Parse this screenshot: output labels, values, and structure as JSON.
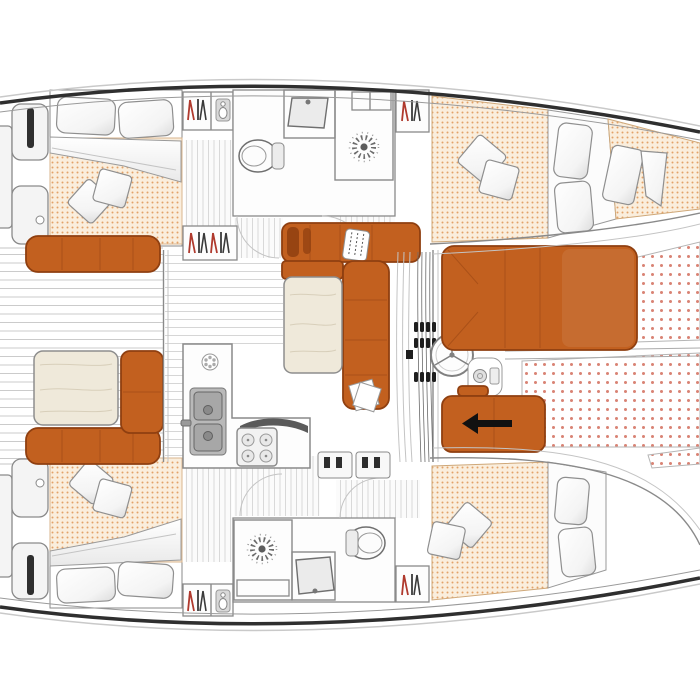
{
  "meta": {
    "title": "Catamaran interior deck layout plan, top-down view, bow to the right",
    "view": "top-down floor plan",
    "orientation_bow": "right"
  },
  "palette": {
    "hull_outline": "#2f2f2f",
    "hull_inner_line": "#9a9a9a",
    "wall": "#8a8a8a",
    "light_line": "#c4c4c4",
    "floor_line": "#d6d6d6",
    "teak_line": "#cbcbcb",
    "upholstery": "#c2601f",
    "upholstery_dark": "#8f3f10",
    "mattress_bg": "#faeedd",
    "mattress_dot": "#e3a268",
    "trampoline_dot": "#d98374",
    "wood_table": "#efe9da",
    "wood_grain": "#d8cfba",
    "fixture_fill": "#f4f4f4",
    "steel": "#b9b9b9",
    "hanger_red": "#b03a2e",
    "hanger_dark": "#3a3a3a",
    "arrow": "#111111",
    "step_tread": "#2e2e2e"
  },
  "regions": {
    "stern_platforms": {
      "label": "Stern swim platforms and transom steps"
    },
    "aft_cockpit": {
      "label": "Aft cockpit with teak floor, bench seats and table"
    },
    "saloon": {
      "label": "Saloon with L-shaped sofa and dining table"
    },
    "galley": {
      "label": "Galley with double sink, hob control and 4-burner stove"
    },
    "helm": {
      "label": "Helm station with steering wheel, winch and line clutches"
    },
    "fwd_cockpit": {
      "label": "Forward cockpit with sunpad lounge and sliding bench"
    },
    "trampoline": {
      "label": "Bow trampoline netting"
    },
    "port_aft_cabin": {
      "label": "Port aft cabin - double berth with pillows and duvet"
    },
    "port_bathroom": {
      "label": "Port bathroom - toilet, washbasin and shower"
    },
    "port_fwd_cabin": {
      "label": "Port forward cabin - double berth"
    },
    "stbd_aft_cabin": {
      "label": "Starboard aft cabin - double berth with pillows and duvet"
    },
    "stbd_bathroom": {
      "label": "Starboard bathroom - shower, washbasin and toilet"
    },
    "stbd_fwd_cabin": {
      "label": "Starboard forward cabin - double berth"
    },
    "wardrobes": {
      "label": "Hanging lockers with clothes hangers"
    }
  },
  "fixtures": {
    "berths": 4,
    "bathrooms": 2,
    "toilets": 2,
    "showers": 2,
    "stove_burners": 4,
    "galley_sink_basins": 2,
    "bathroom_washbasins": 2,
    "helm_wheels": 1,
    "saloon_tables": 1,
    "cockpit_tables": 1,
    "bench_arrow_direction": "left",
    "hanging_lockers": 5
  }
}
